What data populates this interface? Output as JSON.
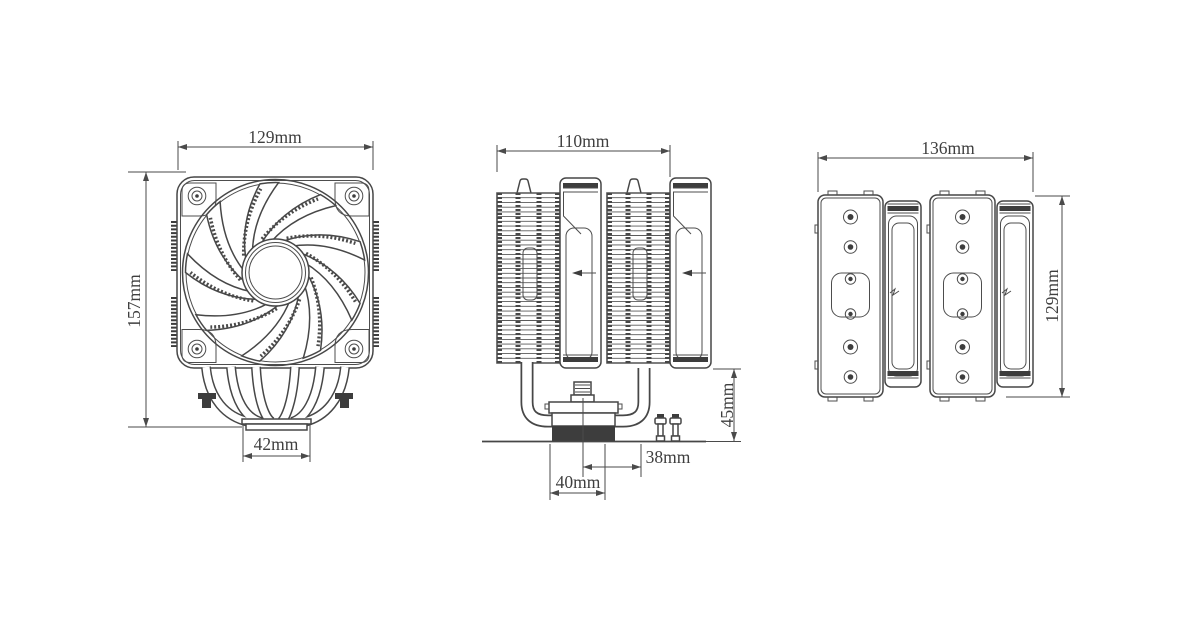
{
  "page": {
    "background_color": "#ffffff",
    "line_color": "#474747",
    "text_color": "#3f3f3f"
  },
  "drawing": {
    "kind": "dual-tower CPU cooler dimensional drawing",
    "views": {
      "front": {
        "width_label": "129mm",
        "height_label": "157mm",
        "base_width_label": "42mm"
      },
      "side": {
        "depth_label": "110mm",
        "base_height_label": "45mm",
        "offset_label": "38mm",
        "base_depth_label": "40mm"
      },
      "rear": {
        "width_label": "136mm",
        "height_label": "129mm"
      }
    }
  }
}
